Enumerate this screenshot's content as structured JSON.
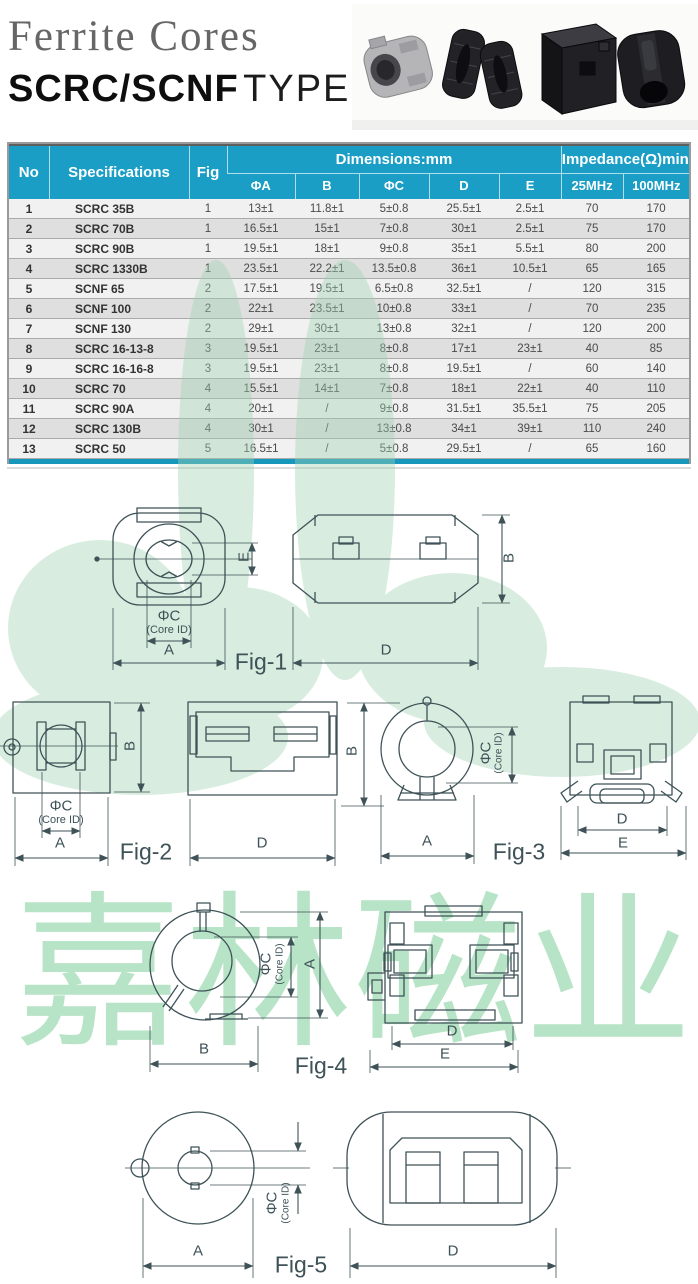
{
  "colors": {
    "header_blue": "#1a9ec6",
    "accent_bar": "#1897bd",
    "watermark_green": "#8fd2a8",
    "drawing_line": "#3e5257"
  },
  "header": {
    "title_line1": "Ferrite Cores",
    "title_line2_bold": "SCRC/SCNF",
    "title_line2_light": "TYPE"
  },
  "table": {
    "col_no": "No",
    "col_specifications": "Specifications",
    "col_fig": "Fig",
    "group_dimensions": "Dimensions:mm",
    "group_impedance": "Impedance(Ω)min",
    "sub_columns": [
      "ΦA",
      "B",
      "ΦC",
      "D",
      "E",
      "25MHz",
      "100MHz"
    ],
    "row_keys": [
      "no",
      "spec",
      "fig",
      "a",
      "b",
      "c",
      "d",
      "e",
      "mhz25",
      "mhz100"
    ],
    "rows": [
      {
        "no": "1",
        "spec": "SCRC 35B",
        "fig": "1",
        "a": "13±1",
        "b": "11.8±1",
        "c": "5±0.8",
        "d": "25.5±1",
        "e": "2.5±1",
        "mhz25": "70",
        "mhz100": "170"
      },
      {
        "no": "2",
        "spec": "SCRC 70B",
        "fig": "1",
        "a": "16.5±1",
        "b": "15±1",
        "c": "7±0.8",
        "d": "30±1",
        "e": "2.5±1",
        "mhz25": "75",
        "mhz100": "170"
      },
      {
        "no": "3",
        "spec": "SCRC 90B",
        "fig": "1",
        "a": "19.5±1",
        "b": "18±1",
        "c": "9±0.8",
        "d": "35±1",
        "e": "5.5±1",
        "mhz25": "80",
        "mhz100": "200"
      },
      {
        "no": "4",
        "spec": "SCRC 1330B",
        "fig": "1",
        "a": "23.5±1",
        "b": "22.2±1",
        "c": "13.5±0.8",
        "d": "36±1",
        "e": "10.5±1",
        "mhz25": "65",
        "mhz100": "165"
      },
      {
        "no": "5",
        "spec": "SCNF 65",
        "fig": "2",
        "a": "17.5±1",
        "b": "19.5±1",
        "c": "6.5±0.8",
        "d": "32.5±1",
        "e": "/",
        "mhz25": "120",
        "mhz100": "315"
      },
      {
        "no": "6",
        "spec": "SCNF 100",
        "fig": "2",
        "a": "22±1",
        "b": "23.5±1",
        "c": "10±0.8",
        "d": "33±1",
        "e": "/",
        "mhz25": "70",
        "mhz100": "235"
      },
      {
        "no": "7",
        "spec": "SCNF 130",
        "fig": "2",
        "a": "29±1",
        "b": "30±1",
        "c": "13±0.8",
        "d": "32±1",
        "e": "/",
        "mhz25": "120",
        "mhz100": "200"
      },
      {
        "no": "8",
        "spec": "SCRC 16-13-8",
        "fig": "3",
        "a": "19.5±1",
        "b": "23±1",
        "c": "8±0.8",
        "d": "17±1",
        "e": "23±1",
        "mhz25": "40",
        "mhz100": "85"
      },
      {
        "no": "9",
        "spec": "SCRC 16-16-8",
        "fig": "3",
        "a": "19.5±1",
        "b": "23±1",
        "c": "8±0.8",
        "d": "19.5±1",
        "e": "/",
        "mhz25": "60",
        "mhz100": "140"
      },
      {
        "no": "10",
        "spec": "SCRC 70",
        "fig": "4",
        "a": "15.5±1",
        "b": "14±1",
        "c": "7±0.8",
        "d": "18±1",
        "e": "22±1",
        "mhz25": "40",
        "mhz100": "110"
      },
      {
        "no": "11",
        "spec": "SCRC 90A",
        "fig": "4",
        "a": "20±1",
        "b": "/",
        "c": "9±0.8",
        "d": "31.5±1",
        "e": "35.5±1",
        "mhz25": "75",
        "mhz100": "205"
      },
      {
        "no": "12",
        "spec": "SCRC 130B",
        "fig": "4",
        "a": "30±1",
        "b": "/",
        "c": "13±0.8",
        "d": "34±1",
        "e": "39±1",
        "mhz25": "110",
        "mhz100": "240"
      },
      {
        "no": "13",
        "spec": "SCRC 50",
        "fig": "5",
        "a": "16.5±1",
        "b": "/",
        "c": "5±0.8",
        "d": "29.5±1",
        "e": "/",
        "mhz25": "65",
        "mhz100": "160"
      }
    ]
  },
  "watermark": {
    "text": "嘉林磁业"
  },
  "figures": {
    "fig1": {
      "caption": "Fig-1",
      "a": "A",
      "b": "B",
      "d": "D",
      "e": "E",
      "phi_c": "ΦC",
      "core_id": "(Core ID)"
    },
    "fig2": {
      "caption": "Fig-2",
      "a": "A",
      "b": "B",
      "d": "D",
      "phi_c": "ΦC",
      "core_id": "(Core ID)"
    },
    "fig3": {
      "caption": "Fig-3",
      "a": "A",
      "b": "B",
      "d": "D",
      "e": "E",
      "phi_c": "ΦC",
      "core_id": "(Core ID)"
    },
    "fig4": {
      "caption": "Fig-4",
      "a": "A",
      "b": "B",
      "d": "D",
      "e": "E",
      "phi_c": "ΦC",
      "core_id": "(Core ID)"
    },
    "fig5": {
      "caption": "Fig-5",
      "a": "A",
      "d": "D",
      "phi_c": "ΦC",
      "core_id": "(Core ID)"
    }
  }
}
